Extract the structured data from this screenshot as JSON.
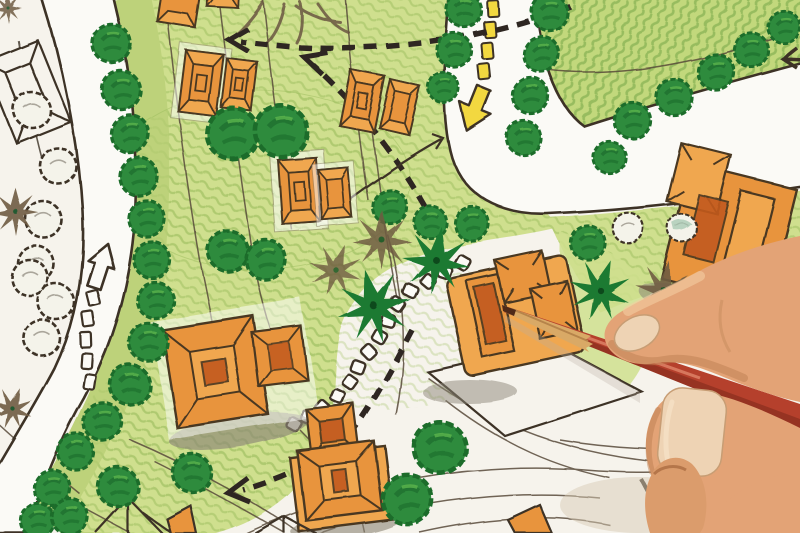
{
  "meta": {
    "description": "Photograph of a hand-drawn landscape architecture site plan in colored pencil; a hand holding a red pencil points at an orange building footprint",
    "visible_text": "none"
  },
  "colors": {
    "paper": "#f6f3ec",
    "ink": "#3c3226",
    "road": "#fbfaf6",
    "lawn": "#cfdf8e",
    "lawnTR": "#c2d87c",
    "median": "#b9d074",
    "lawnStripe": "#9cbd5e",
    "lawnDark": "#74a545",
    "treeGreen": "#2e8b3d",
    "treeDark": "#1c6c2c",
    "treeLight": "#5cb54d",
    "paleTree": "#f4f3ea",
    "palmGreen": "#1f7a33",
    "palmBrown": "#6f5c42",
    "bldOrange": "#e8943c",
    "bldOrangeLight": "#f0a74f",
    "bldSienna": "#c25a1d",
    "bldOutline": "#4a3822",
    "yellow": "#f2d840",
    "shadowGray": "#8c8577",
    "contour": "#584b3a",
    "skin": "#e3a376",
    "skinMid": "#db9c6c",
    "skinLight": "#f4cda2",
    "skinShadow": "#bd7f52",
    "skinDeep": "#96572f",
    "nail": "#eed3b4",
    "pencilWood": "#d9a966",
    "pencilWoodDark": "#b6844a",
    "pencilRed": "#b5402c",
    "pencilRedDark": "#8c2f1f",
    "pencilTip": "#4f2a18"
  },
  "scene": {
    "plan_elements": [
      "curving residential road with white route-marker dashes and outline arrow",
      "looping road with yellow center dashes and large yellow directional arrow",
      "rows of round scribbled trees lining the roads",
      "uncolored outline trees on white margin",
      "palm and fern symbols at plan center",
      "twelve orange building footprints with hip-roof plan linework",
      "white stepping-stone path of small squares",
      "black dashed pedestrian-flow arrows",
      "thin contour and lot-boundary lines",
      "graphite shadow smudges beside buildings"
    ],
    "foreground": [
      "human hand entering from lower right",
      "red colored pencil with sharpened wood tip touching a building footprint",
      "thumb nail and index finger nail visible"
    ],
    "counts": {
      "orange_buildings": 12,
      "dark_round_trees": 38,
      "pale_outline_trees": 8,
      "palm_symbols": 6,
      "stepping_stones": 14
    }
  }
}
